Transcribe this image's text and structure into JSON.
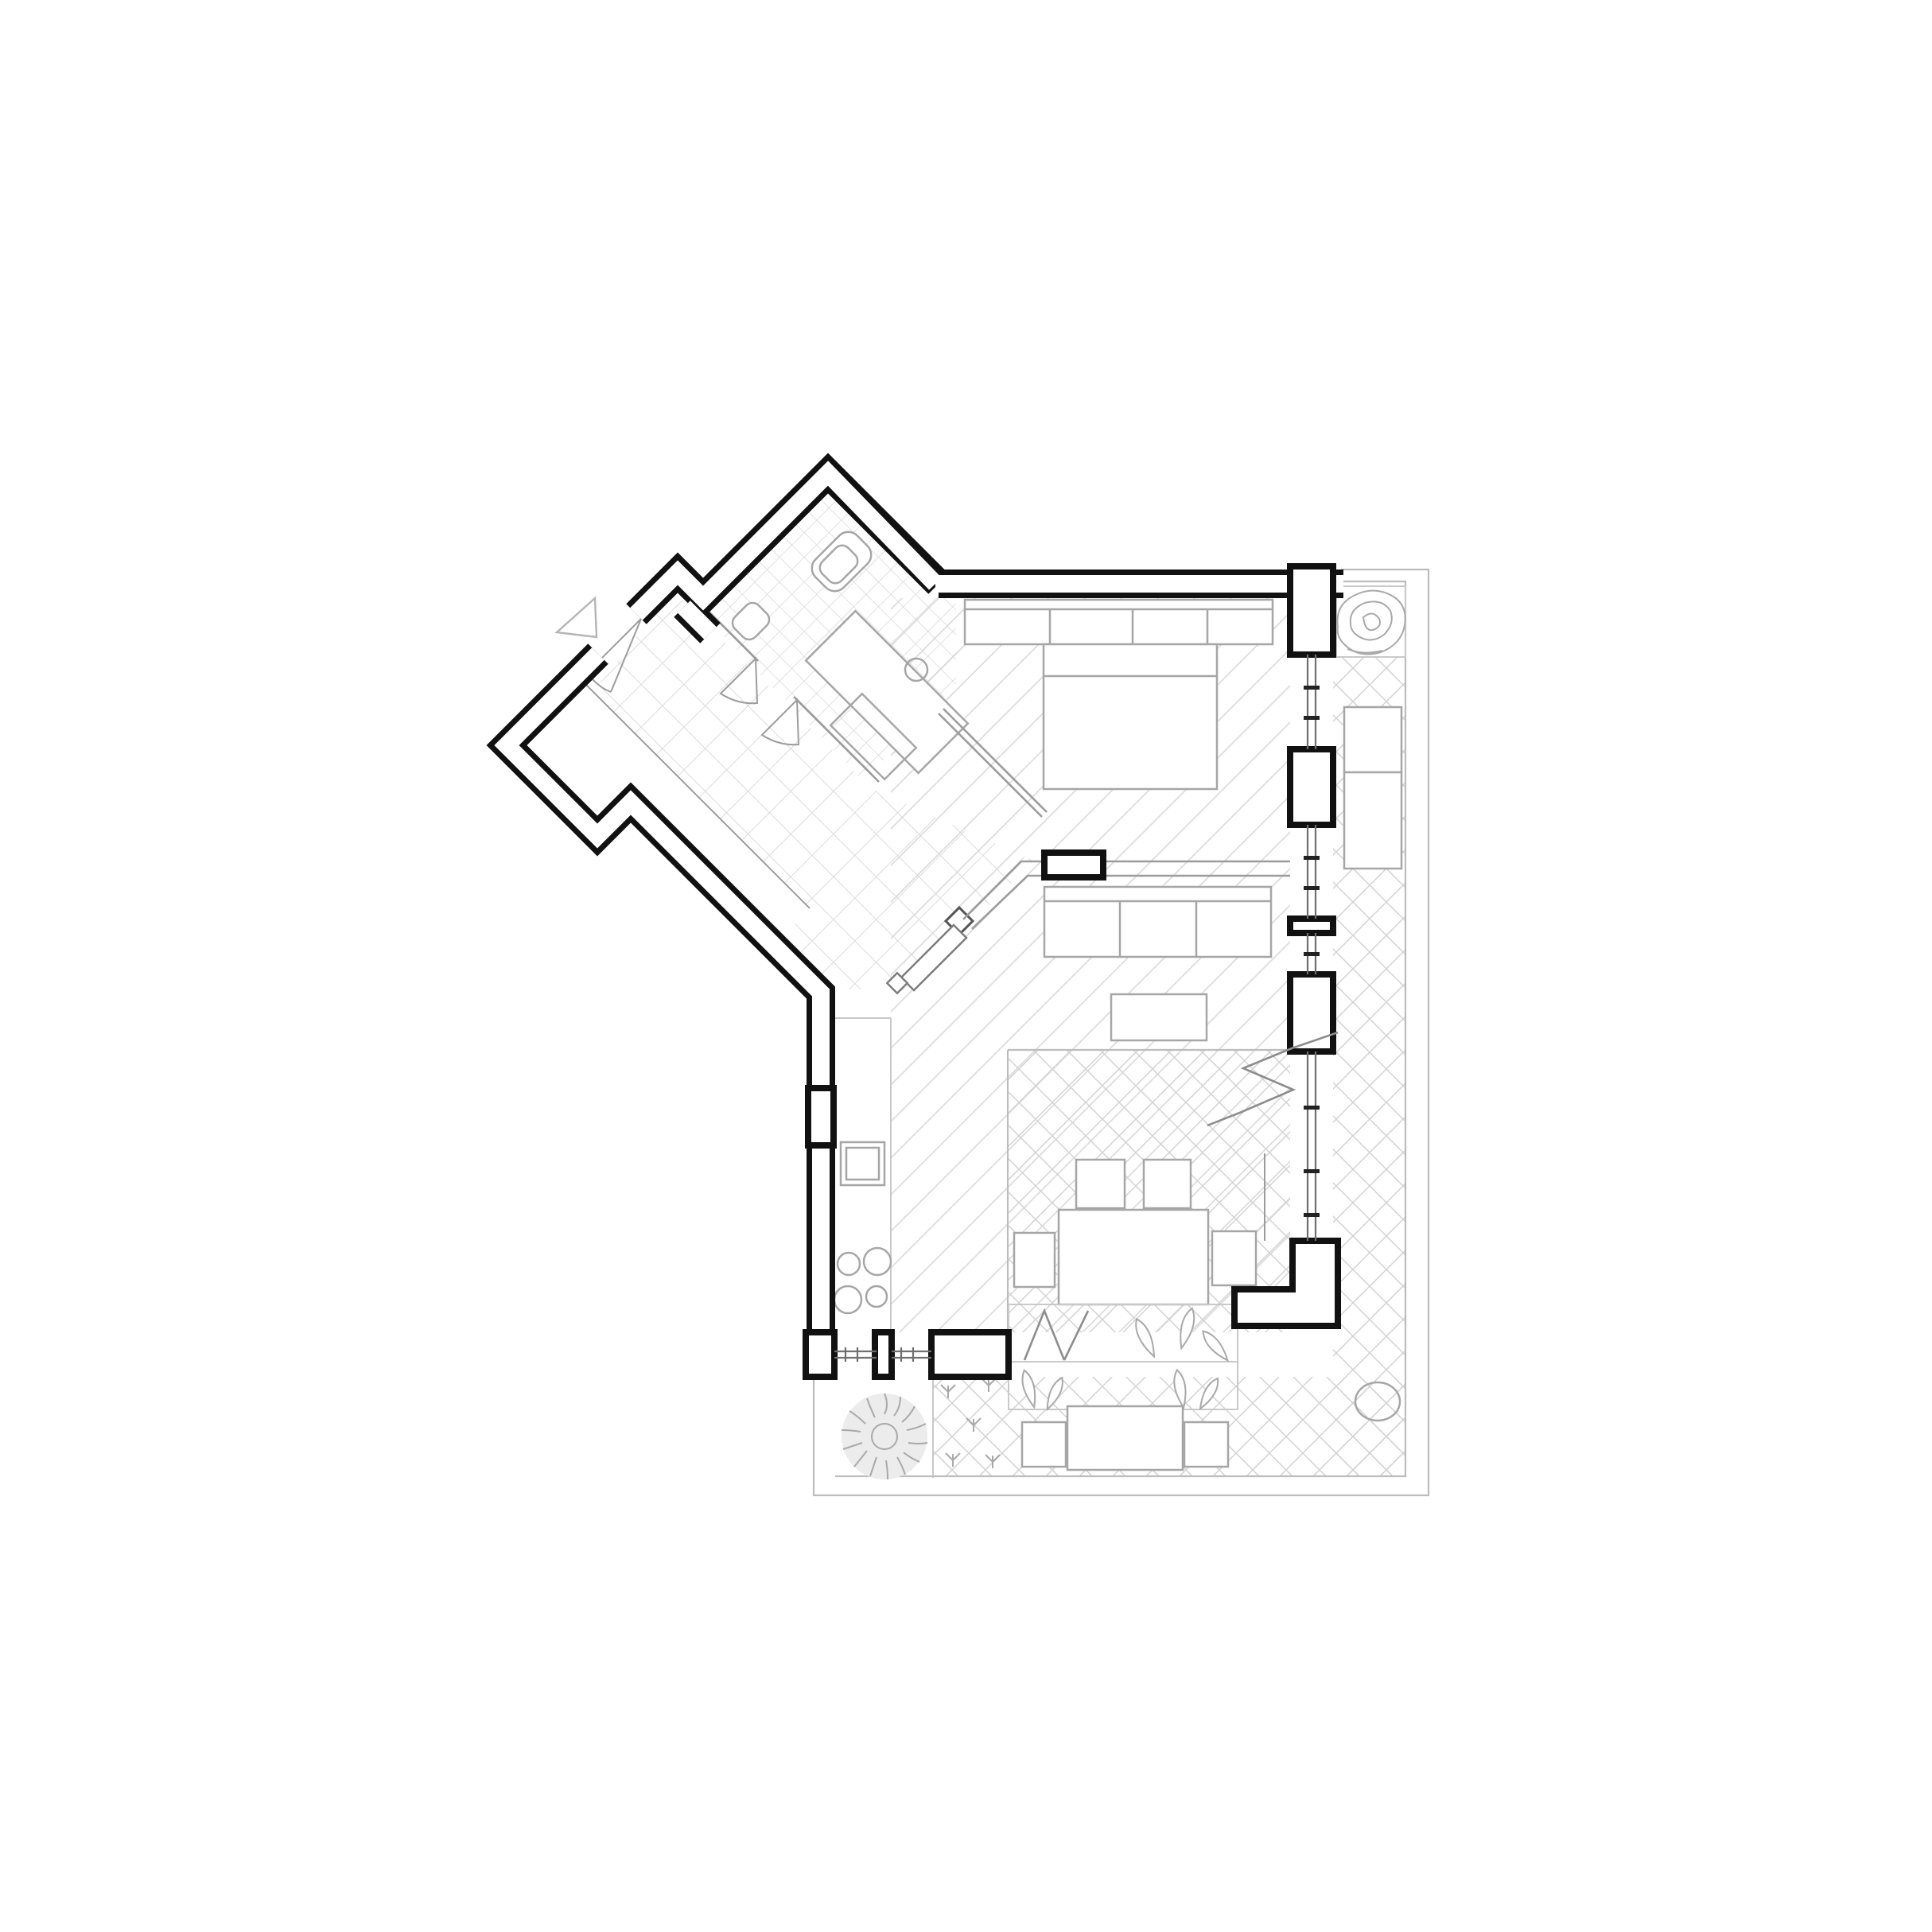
{
  "meta": {
    "drawing_type": "architectural floor plan",
    "style": "minimal black-and-white ink line drawing, top-down view",
    "visible_text": "none",
    "aria_label": "Black and white architectural floor plan of an apartment with a 45-degree angled entrance wing, bathroom, bedroom, living and dining room, kitchen, and a wrap-around terrace with plants"
  },
  "palette": {
    "background": "#ffffff",
    "ink": "#111111",
    "furniture_line": "#a6a6a6",
    "light_line": "#c9c9c9",
    "tile_line": "#d6d6d6",
    "hatch_line": "#dcdcdc",
    "cross_line": "#d2d2d2",
    "boundary_line": "#bdbdbd",
    "plant_line": "#a9a9a9",
    "door_swing_line": "#9c9c9c"
  },
  "floors": [
    {
      "name": "entry-hall",
      "finish": "large square tiles",
      "pattern": "grid-45deg-38px"
    },
    {
      "name": "bathroom",
      "finish": "small square tiles",
      "pattern": "grid-45deg-22px"
    },
    {
      "name": "bedroom-living",
      "finish": "diagonal hatch",
      "pattern": "single-diagonal-33px"
    },
    {
      "name": "dining-area",
      "finish": "cross hatch",
      "pattern": "diamond-42px"
    },
    {
      "name": "kitchen-strip",
      "finish": "plain white",
      "pattern": "none"
    },
    {
      "name": "balcony-and-terrace",
      "finish": "cross hatch",
      "pattern": "diamond-42px"
    },
    {
      "name": "garden-bed",
      "finish": "planting soil with tree and sprouts",
      "pattern": "none"
    }
  ],
  "walls": {
    "exterior_style": "double black line with white core",
    "window_piers_right_wall": 4,
    "bottom_wall_piers": 3,
    "corner_l_pier": 1,
    "interior_partition": "thin double grey line with black door jamb pier"
  },
  "furniture": [
    "wardrobe with four sections",
    "double bed",
    "three-seat sofa",
    "coffee table",
    "dining table with four chairs",
    "kitchen counter with sink and four-burner hob",
    "sun lounger on balcony",
    "outdoor table with two chairs",
    "round outdoor table",
    "two-tier planter bench with leafy plants"
  ],
  "fixtures": [
    "wall-hung toilet",
    "bidet",
    "vanity counter with round basin",
    "under-vanity shelf",
    "glass screen"
  ],
  "openings": [
    "entrance door with swing arc and direction triangle",
    "double bathroom door fans",
    "hall-to-living door with angled leaf and handle",
    "four glazed window bands with mullion ticks",
    "two sill windows in bottom wall"
  ],
  "symbols": [
    "entrance direction triangle",
    "break line zigzag on terrace",
    "break line on planter",
    "tree in plan (balcony)",
    "fluffy tree in plan (garden bed)",
    "grass sprout marks"
  ]
}
